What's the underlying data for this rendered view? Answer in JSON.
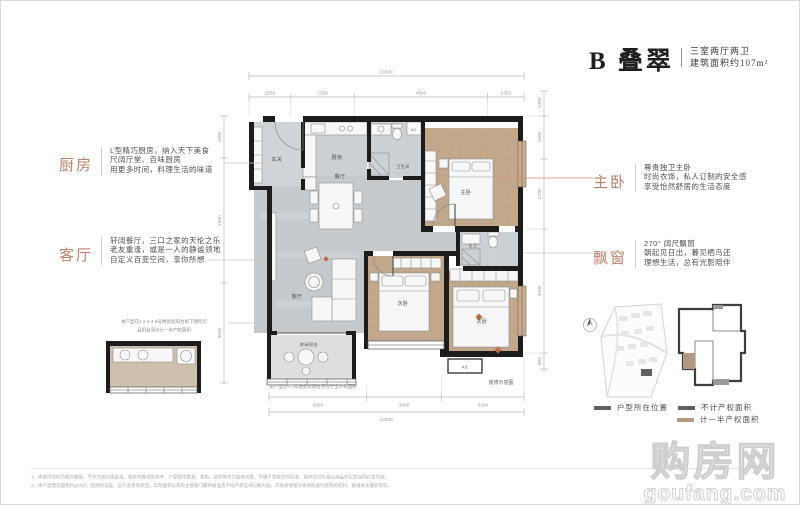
{
  "header": {
    "title": "B 叠翠",
    "spec": "三室两厅两卫",
    "area": "建筑面积约107m²"
  },
  "annotations": {
    "kitchen": {
      "label": "厨房",
      "lines": [
        "L型精巧厨房，纳入天下美食",
        "尺阔厅堂、百味厨房",
        "用更多时间，料理生活的味道"
      ]
    },
    "living": {
      "label": "客厅",
      "lines": [
        "轩阔餐厅，三口之家的天伦之乐",
        "老友重逢，或是一人的静谧领地",
        "自定义百变空间，享你所想"
      ]
    },
    "master": {
      "label": "主卧",
      "lines": [
        "尊贵独卫主卧",
        "时尚衣饰，私人订制的安全感",
        "享受怡然舒居的生活态度"
      ]
    },
    "bay": {
      "label": "飘窗",
      "lines": [
        "270° 阔尺飘窗",
        "朝起见日出，暮见栖鸟还",
        "理想生活，总有光影陪伴"
      ]
    }
  },
  "plan": {
    "rooms": {
      "entry": "玄关",
      "kitchen": "厨房",
      "dining": "餐厅",
      "living": "客厅",
      "leisure_balcony": "休闲阳台",
      "master": "主卧",
      "bedroom_b": "次卧",
      "bedroom_c": "次卧",
      "bath": "卫生间",
      "master_bath": "主卫",
      "ac": "AC",
      "ac2": "AC"
    },
    "dims": {
      "top": {
        "total": "10200",
        "segments": [
          "1550",
          "2350",
          "4950",
          "1350"
        ]
      },
      "bottom": {
        "total": "10200",
        "segments": [
          "3900",
          "3000",
          "3300"
        ]
      },
      "left": {
        "segments": [
          "1500",
          "4400",
          "3500"
        ]
      },
      "right": {
        "segments": [
          "1000",
          "1600",
          "2700",
          "3500",
          "600"
        ]
      }
    },
    "notes": {
      "note1a": "本户型在1·2·3·4·5号楼此处阳台如下图所示",
      "note1b": "且阳台须分计一半产权面积",
      "note2": "本户型在6·7号楼此处阳台须分计全产权面积",
      "caption": "装修示意图"
    }
  },
  "legend": {
    "items": [
      {
        "label": "户型所在位置",
        "color": "#5f6163"
      },
      {
        "label": "不计产权面积",
        "color": "#5f6163"
      },
      {
        "label": "计一半产权面积",
        "color": "#b29a7e"
      }
    ]
  },
  "footer": {
    "line1": "1、本宣传资料为要约邀请，不作为要约或承诺，相关内容仅供参考；户型图中家具、家电、装饰等仅为装修示意，不属于实际交付标准，具体交付标准以商品房买卖合同约定为准。",
    "line2": "2、本户型建筑面积约107㎡，因测绘误差、设计变更等原因，实际面积以政府主管部门最终核准及不动产权证书记载为准；开发商保留对本资料进行修改的权利，敬请关注最新资料。"
  },
  "watermark": {
    "name": "购房网",
    "domain": "goufang.com"
  },
  "colors": {
    "accent": "#b8836a",
    "wall": "#1c1c1c",
    "wood": "#c3a98c",
    "tan": "#b29a7e",
    "marker": "#bf6c48"
  }
}
